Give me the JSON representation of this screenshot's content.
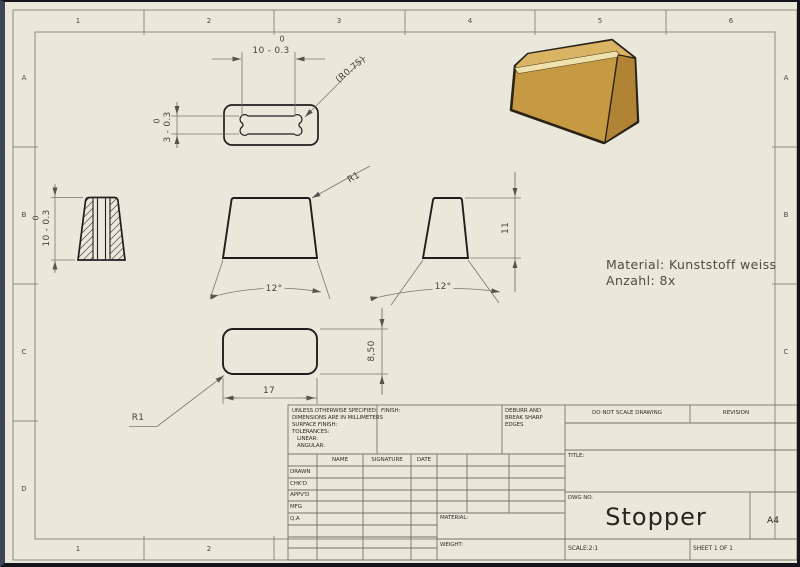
{
  "sheet": {
    "zones": {
      "top": [
        "1",
        "2",
        "3",
        "4",
        "5",
        "6"
      ],
      "bottom": [
        "1",
        "2"
      ],
      "left": [
        "A",
        "B",
        "C",
        "D"
      ],
      "right": [
        "A",
        "B",
        "C"
      ]
    }
  },
  "notes": {
    "material": "Material: Kunststoff weiss",
    "quantity": "Anzahl: 8x"
  },
  "dims": {
    "top_width_upper": "0",
    "top_width": "10 - 0.3",
    "slot_radius": "(R0.75)",
    "slot_height_upper": "0",
    "slot_height": "3 - 0.3",
    "side_height_upper": "0",
    "side_height": "10 - 0.3",
    "front_radius": "R1",
    "front_angle": "12°",
    "right_height": "11",
    "right_angle": "12°",
    "bottom_length": "17",
    "bottom_height": "8,50",
    "bottom_radius": "R1"
  },
  "part_colors": {
    "front": "#c69a43",
    "top": "#d9b464",
    "bevel": "#efe0ac",
    "side": "#b18435",
    "outline": "#2a2217"
  },
  "title_block": {
    "tol_line1": "UNLESS OTHERWISE SPECIFIED:",
    "tol_line2": "DIMENSIONS ARE IN MILLIMETERS",
    "tol_line3": "SURFACE FINISH:",
    "tol_line4": "TOLERANCES:",
    "tol_line5": "LINEAR:",
    "tol_line6": "ANGULAR:",
    "finish_label": "FINISH:",
    "debur_line1": "DEBURR AND",
    "debur_line2": "BREAK SHARP",
    "debur_line3": "EDGES",
    "do_not_scale": "DO NOT SCALE DRAWING",
    "revision_label": "REVISION",
    "col_name": "NAME",
    "col_signature": "SIGNATURE",
    "col_date": "DATE",
    "row_drawn": "DRAWN",
    "row_chkd": "CHK'D",
    "row_appvd": "APPV'D",
    "row_mfg": "MFG",
    "row_qa": "Q.A",
    "title_label": "TITLE:",
    "material_label": "MATERIAL:",
    "weight_label": "WEIGHT:",
    "dwg_label": "DWG NO.",
    "drawing_title": "Stopper",
    "paper_size": "A4",
    "scale_label": "SCALE:2:1",
    "sheet_label": "SHEET 1 OF 1"
  }
}
